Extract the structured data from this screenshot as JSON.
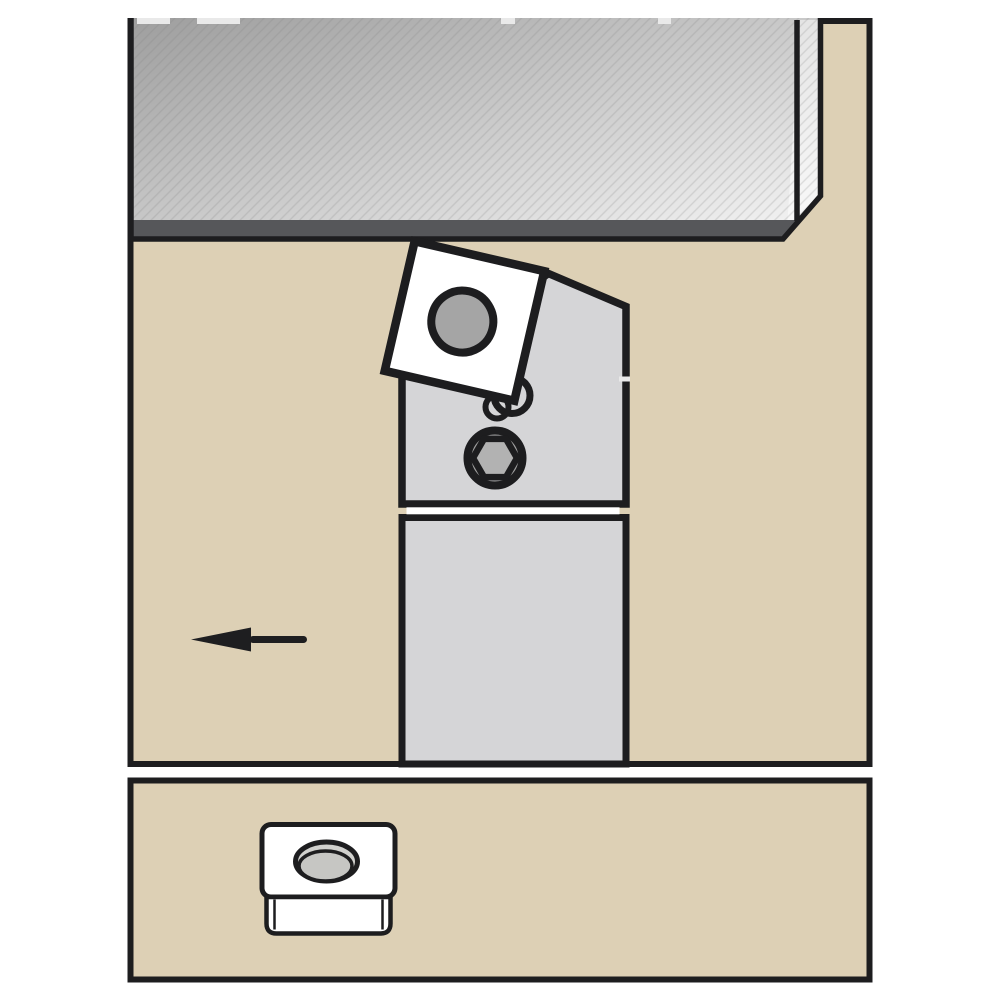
{
  "diagram": {
    "kind": "turning-tool-application-illustration",
    "main_view_parts": [
      "workpiece",
      "machined-surface-band",
      "workpiece-end-face",
      "tool-holder-head",
      "tool-shank",
      "indexable-insert",
      "insert-hole",
      "clamp-screw",
      "hex-socket",
      "insert-corner-rings",
      "feed-direction-arrow"
    ],
    "detail_view_parts": [
      "insert-top-face",
      "insert-side-face",
      "insert-center-hole"
    ]
  },
  "colors": {
    "page_bg": "#ffffff",
    "ink": "#1d1d1f",
    "panel_tan": "#ddd0b5",
    "workpiece_dark": "#9e9e9e",
    "workpiece_light": "#f6f6f6",
    "hatch_line": "#7f7f7f",
    "band_dark": "#56575a",
    "end_face_tint": "#ffffff",
    "steel_gray": "#d5d5d7",
    "insert_white": "#ffffff",
    "insert_hole_gray": "#a5a5a5",
    "screw_ring_gray": "#a0a0a0",
    "hex_center_gray": "#b2b2b2",
    "arrow_black": "#1e1e20",
    "hole_rim_gray": "#d0d0cd",
    "hole_bore_gray": "#c6c6c3",
    "border_gap_light": "#e9e9e9",
    "joint_gap_white": "#ffffff"
  }
}
